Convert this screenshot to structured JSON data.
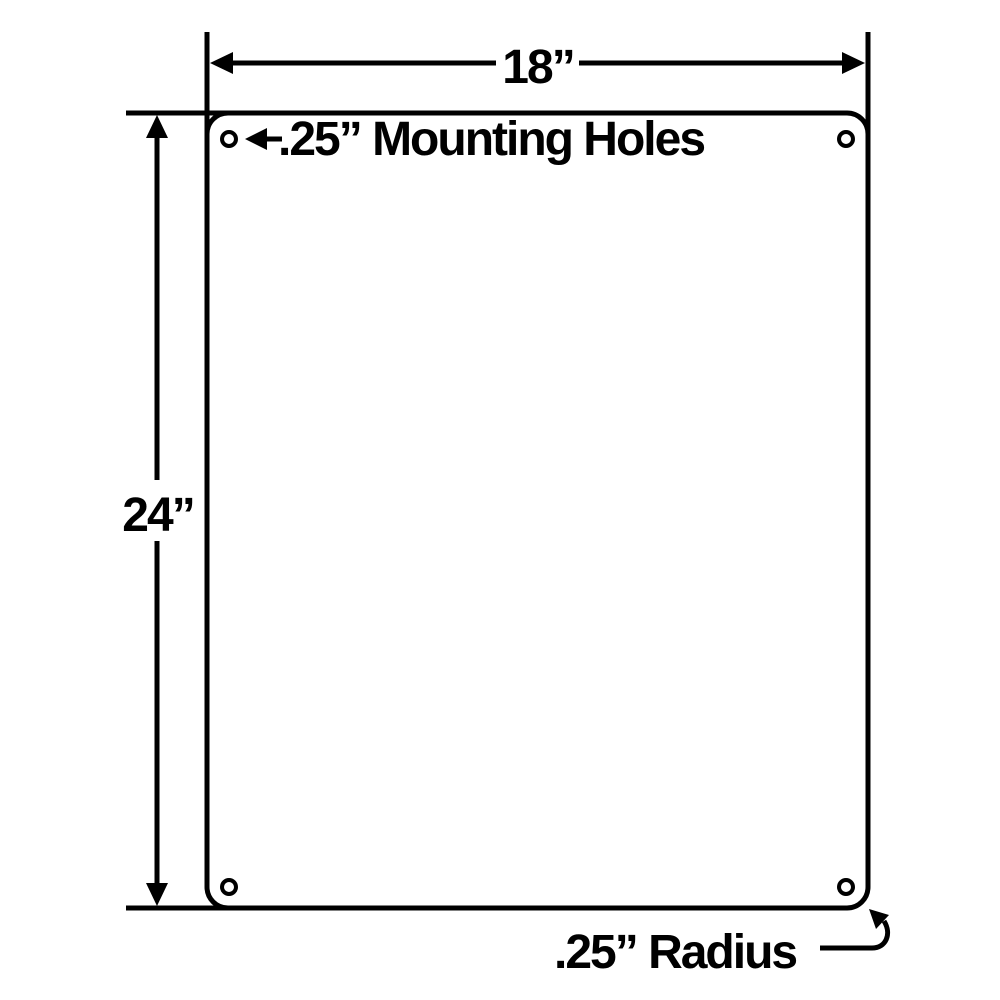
{
  "drawing": {
    "background_color": "#ffffff",
    "line_color": "#000000",
    "panel": {
      "width_label": "18”",
      "height_label": "24”",
      "mounting_holes_label": ".25” Mounting Holes",
      "corner_radius_label": ".25” Radius",
      "mounting_hole_count": 4
    }
  }
}
